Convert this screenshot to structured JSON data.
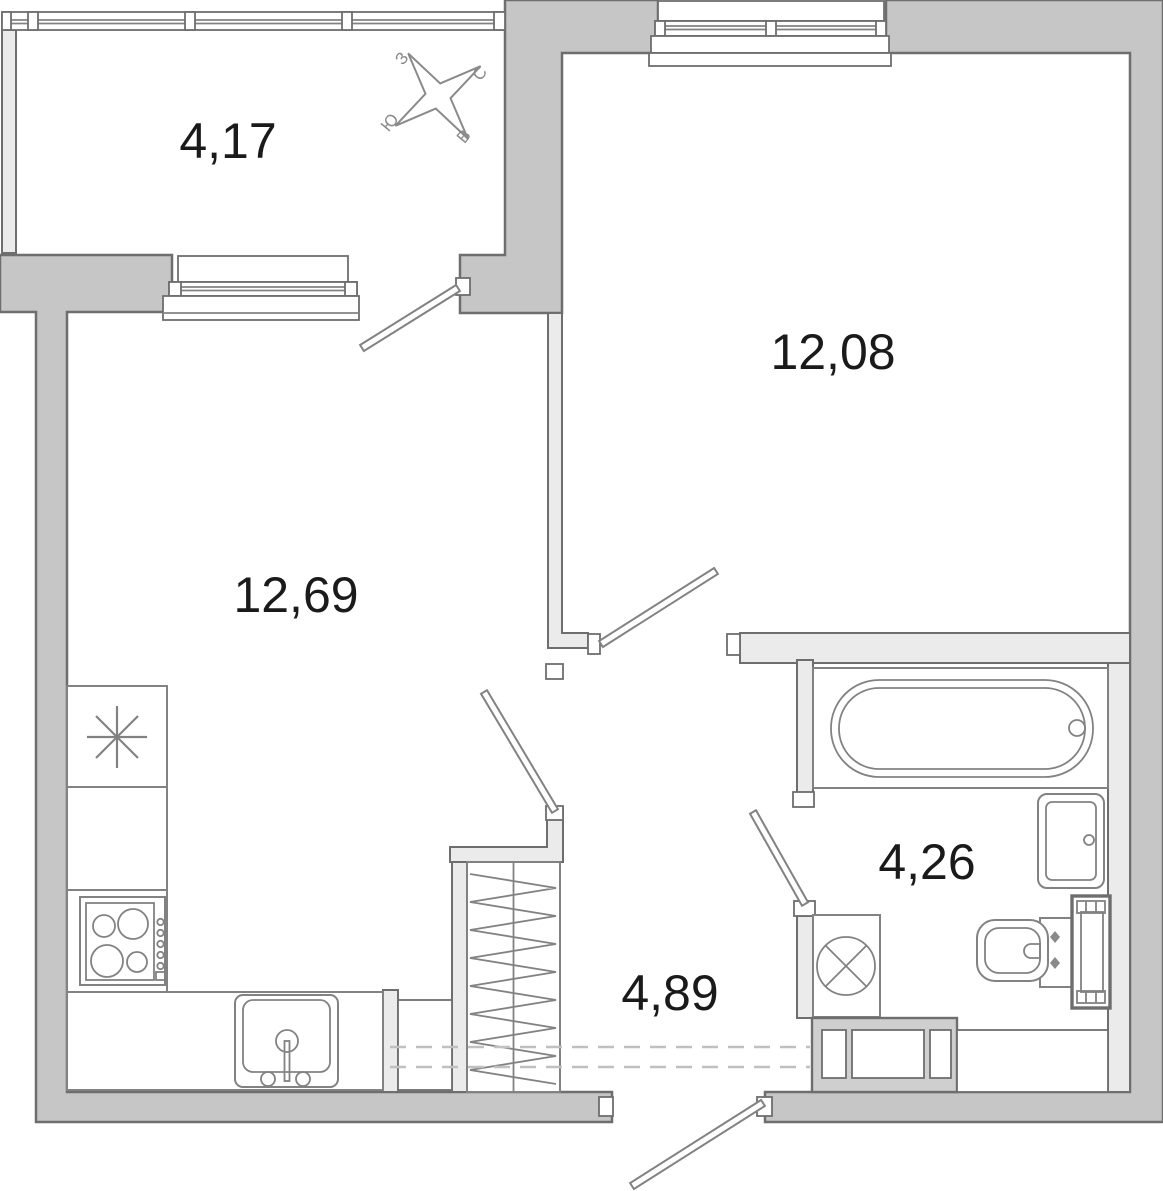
{
  "rooms": {
    "balcony": {
      "area": "4,17"
    },
    "bedroom": {
      "area": "12,08"
    },
    "living_kitchen": {
      "area": "12,69"
    },
    "bathroom": {
      "area": "4,26"
    },
    "hallway": {
      "area": "4,89"
    }
  },
  "compass": {
    "north": "С",
    "south": "Ю",
    "west": "З",
    "east": "В"
  },
  "colors": {
    "outer-wall": "#c6c6c6",
    "inner-wall": "#ebebeb",
    "line-strong": "#6e6e6e",
    "line-fixture": "#828282",
    "text": "#1a1a1a",
    "dashed": "#c0c0c0",
    "cabinet": "#cfcfcf",
    "compass": "#8a8a8a",
    "background": "#ffffff"
  }
}
